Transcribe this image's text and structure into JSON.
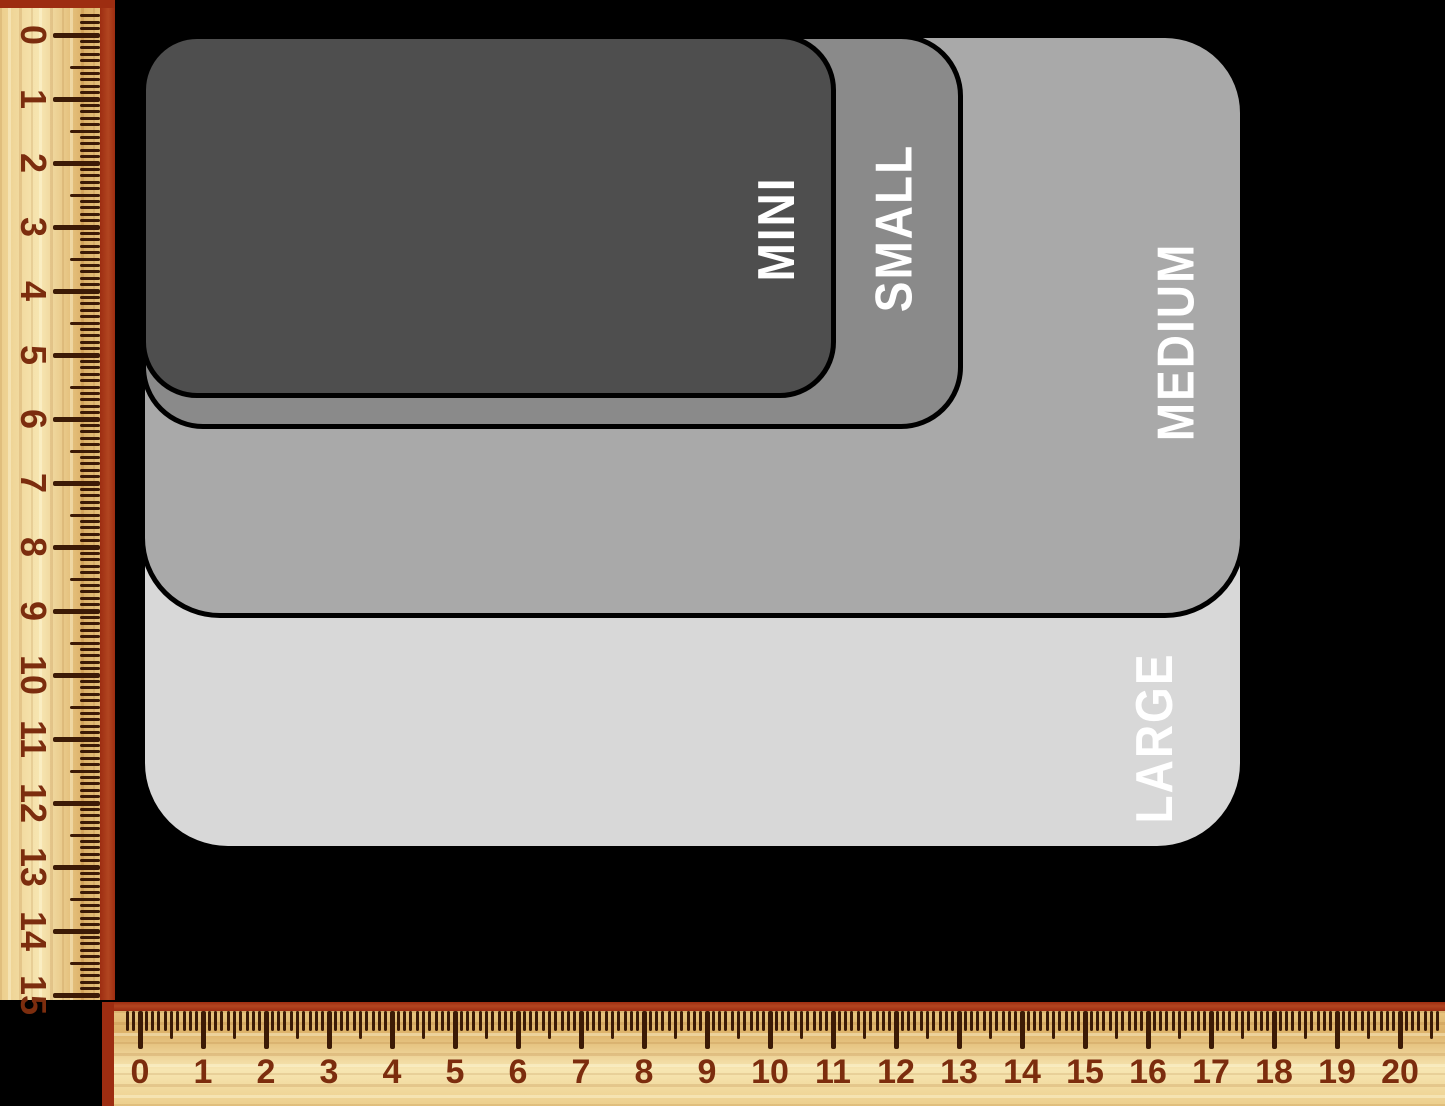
{
  "diagram": {
    "background_color": "#000000",
    "outline_color": "#000000",
    "label_color": "#ffffff",
    "sizes": [
      {
        "label": "MINI",
        "fill": "#4e4e4e",
        "width_cm": 11.0,
        "height_cm": 5.7,
        "px": {
          "x": 141,
          "y": 34,
          "w": 695,
          "h": 364,
          "r": 56,
          "label_right": 55,
          "label_center_y": 190
        }
      },
      {
        "label": "SMALL",
        "fill": "#8a8a8a",
        "width_cm": 13.0,
        "height_cm": 6.2,
        "px": {
          "x": 141,
          "y": 34,
          "w": 822,
          "h": 395,
          "r": 62,
          "label_right": 65,
          "label_center_y": 189
        }
      },
      {
        "label": "MEDIUM",
        "fill": "#a9a9a9",
        "width_cm": 17.5,
        "height_cm": 9.1,
        "px": {
          "x": 140,
          "y": 33,
          "w": 1105,
          "h": 585,
          "r": 80,
          "label_right": 64,
          "label_center_y": 304
        }
      },
      {
        "label": "LARGE",
        "fill": "#d8d8d8",
        "width_cm": 17.5,
        "height_cm": 12.8,
        "px": {
          "x": 140,
          "y": 33,
          "w": 1105,
          "h": 818,
          "r": 88,
          "label_right": 86,
          "label_center_y": 700
        }
      }
    ]
  },
  "rulers": {
    "unit": "cm",
    "wood_light": "#f7e6b2",
    "wood_mid": "#ecce8c",
    "wood_dark": "#ddb269",
    "edge_red": "#9d2d11",
    "tick_color": "#3c1a06",
    "number_color": "#7c2d0e",
    "vertical": {
      "numbers": [
        "0",
        "1",
        "2",
        "3",
        "4",
        "5",
        "6",
        "7",
        "8",
        "9",
        "10",
        "11",
        "12",
        "13",
        "14",
        "15"
      ],
      "origin_px": 35,
      "px_per_cm": 64,
      "mm_start": -3,
      "mm_end": 150,
      "tick_major_len": 47,
      "tick_half_len": 30,
      "tick_minor_len": 20,
      "number_center_x": 33
    },
    "horizontal": {
      "numbers": [
        "0",
        "1",
        "2",
        "3",
        "4",
        "5",
        "6",
        "7",
        "8",
        "9",
        "10",
        "11",
        "12",
        "13",
        "14",
        "15",
        "16",
        "17",
        "18",
        "19",
        "20"
      ],
      "origin_px": 140,
      "px_per_cm": 63,
      "mm_start": -2,
      "mm_end": 206,
      "tick_major_len": 38,
      "tick_half_len": 28,
      "tick_minor_len": 20,
      "number_center_y": 70
    }
  }
}
